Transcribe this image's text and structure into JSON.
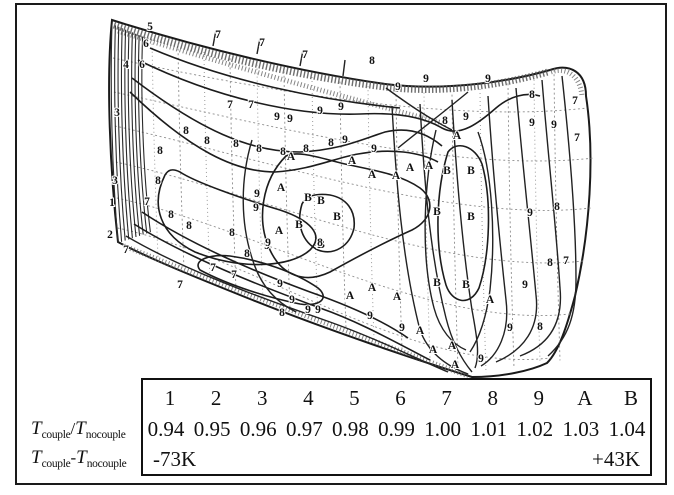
{
  "legend_table": {
    "levels": [
      "1",
      "2",
      "3",
      "4",
      "5",
      "6",
      "7",
      "8",
      "9",
      "A",
      "B"
    ],
    "ratios": [
      "0.94",
      "0.95",
      "0.96",
      "0.97",
      "0.98",
      "0.99",
      "1.00",
      "1.01",
      "1.02",
      "1.03",
      "1.04"
    ],
    "delta_min": "-73K",
    "delta_max": "+43K"
  },
  "side_labels": {
    "ratio": {
      "T1": "T",
      "sub1": "couple",
      "op": "/",
      "T2": "T",
      "sub2": "nocouple"
    },
    "delta": {
      "T1": "T",
      "sub1": "couple",
      "op": "-",
      "T2": "T",
      "sub2": "nocouple"
    }
  },
  "chart_data": {
    "type": "heatmap",
    "subtype": "contour",
    "title": "",
    "legend_position": "bottom",
    "contour_levels": [
      "1",
      "2",
      "3",
      "4",
      "5",
      "6",
      "7",
      "8",
      "9",
      "A",
      "B"
    ],
    "series": [
      {
        "name": "Tcouple/Tnocouple",
        "values": [
          0.94,
          0.95,
          0.96,
          0.97,
          0.98,
          0.99,
          1.0,
          1.01,
          1.02,
          1.03,
          1.04
        ]
      },
      {
        "name": "Tcouple-Tnocouple",
        "range": [
          "-73K",
          "+43K"
        ]
      }
    ]
  },
  "contour": {
    "labels": [
      {
        "c": "5",
        "x": 150,
        "y": 30
      },
      {
        "c": "6",
        "x": 146,
        "y": 47
      },
      {
        "c": "6",
        "x": 142,
        "y": 68
      },
      {
        "c": "4",
        "x": 126,
        "y": 68
      },
      {
        "c": "3",
        "x": 117,
        "y": 116
      },
      {
        "c": "3",
        "x": 115,
        "y": 184
      },
      {
        "c": "1",
        "x": 112,
        "y": 206
      },
      {
        "c": "2",
        "x": 110,
        "y": 238
      },
      {
        "c": "7",
        "x": 147,
        "y": 205
      },
      {
        "c": "8",
        "x": 160,
        "y": 154
      },
      {
        "c": "8",
        "x": 158,
        "y": 184
      },
      {
        "c": "8",
        "x": 171,
        "y": 218
      },
      {
        "c": "8",
        "x": 189,
        "y": 229
      },
      {
        "c": "8",
        "x": 186,
        "y": 134
      },
      {
        "c": "8",
        "x": 207,
        "y": 144
      },
      {
        "c": "7",
        "x": 218,
        "y": 38
      },
      {
        "c": "7",
        "x": 262,
        "y": 46
      },
      {
        "c": "7",
        "x": 305,
        "y": 58
      },
      {
        "c": "7",
        "x": 230,
        "y": 108
      },
      {
        "c": "7",
        "x": 251,
        "y": 108
      },
      {
        "c": "8",
        "x": 236,
        "y": 147
      },
      {
        "c": "8",
        "x": 259,
        "y": 152
      },
      {
        "c": "8",
        "x": 283,
        "y": 155
      },
      {
        "c": "8",
        "x": 306,
        "y": 152
      },
      {
        "c": "8",
        "x": 331,
        "y": 146
      },
      {
        "c": "9",
        "x": 277,
        "y": 120
      },
      {
        "c": "9",
        "x": 290,
        "y": 122
      },
      {
        "c": "9",
        "x": 320,
        "y": 114
      },
      {
        "c": "9",
        "x": 341,
        "y": 110
      },
      {
        "c": "8",
        "x": 372,
        "y": 64
      },
      {
        "c": "9",
        "x": 398,
        "y": 90
      },
      {
        "c": "9",
        "x": 426,
        "y": 82
      },
      {
        "c": "9",
        "x": 488,
        "y": 82
      },
      {
        "c": "8",
        "x": 532,
        "y": 98
      },
      {
        "c": "7",
        "x": 575,
        "y": 104
      },
      {
        "c": "9",
        "x": 554,
        "y": 128
      },
      {
        "c": "7",
        "x": 577,
        "y": 141
      },
      {
        "c": "9",
        "x": 532,
        "y": 126
      },
      {
        "c": "8",
        "x": 445,
        "y": 124
      },
      {
        "c": "9",
        "x": 466,
        "y": 120
      },
      {
        "c": "9",
        "x": 345,
        "y": 143
      },
      {
        "c": "9",
        "x": 374,
        "y": 152
      },
      {
        "c": "A",
        "x": 352,
        "y": 164
      },
      {
        "c": "A",
        "x": 372,
        "y": 178
      },
      {
        "c": "A",
        "x": 396,
        "y": 179
      },
      {
        "c": "A",
        "x": 410,
        "y": 171
      },
      {
        "c": "A",
        "x": 429,
        "y": 169
      },
      {
        "c": "A",
        "x": 457,
        "y": 139
      },
      {
        "c": "B",
        "x": 447,
        "y": 174
      },
      {
        "c": "B",
        "x": 471,
        "y": 174
      },
      {
        "c": "A",
        "x": 291,
        "y": 160
      },
      {
        "c": "A",
        "x": 281,
        "y": 191
      },
      {
        "c": "A",
        "x": 279,
        "y": 234
      },
      {
        "c": "B",
        "x": 308,
        "y": 201
      },
      {
        "c": "B",
        "x": 321,
        "y": 204
      },
      {
        "c": "B",
        "x": 337,
        "y": 220
      },
      {
        "c": "B",
        "x": 299,
        "y": 228
      },
      {
        "c": "B",
        "x": 321,
        "y": 248
      },
      {
        "c": "9",
        "x": 257,
        "y": 197
      },
      {
        "c": "9",
        "x": 256,
        "y": 211
      },
      {
        "c": "9",
        "x": 267,
        "y": 249
      },
      {
        "c": "9",
        "x": 280,
        "y": 287
      },
      {
        "c": "B",
        "x": 437,
        "y": 215
      },
      {
        "c": "B",
        "x": 471,
        "y": 220
      },
      {
        "c": "8",
        "x": 557,
        "y": 210
      },
      {
        "c": "9",
        "x": 530,
        "y": 216
      },
      {
        "c": "8",
        "x": 540,
        "y": 330
      },
      {
        "c": "9",
        "x": 525,
        "y": 288
      },
      {
        "c": "8",
        "x": 550,
        "y": 266
      },
      {
        "c": "7",
        "x": 566,
        "y": 264
      },
      {
        "c": "8",
        "x": 232,
        "y": 236
      },
      {
        "c": "9",
        "x": 268,
        "y": 246
      },
      {
        "c": "8",
        "x": 247,
        "y": 257
      },
      {
        "c": "9",
        "x": 292,
        "y": 303
      },
      {
        "c": "8",
        "x": 282,
        "y": 316
      },
      {
        "c": "9",
        "x": 308,
        "y": 313
      },
      {
        "c": "9",
        "x": 318,
        "y": 313
      },
      {
        "c": "7",
        "x": 213,
        "y": 271
      },
      {
        "c": "7",
        "x": 234,
        "y": 278
      },
      {
        "c": "7",
        "x": 180,
        "y": 288
      },
      {
        "c": "7",
        "x": 126,
        "y": 253
      },
      {
        "c": "8",
        "x": 320,
        "y": 246
      },
      {
        "c": "A",
        "x": 350,
        "y": 299
      },
      {
        "c": "A",
        "x": 372,
        "y": 291
      },
      {
        "c": "A",
        "x": 397,
        "y": 300
      },
      {
        "c": "9",
        "x": 370,
        "y": 319
      },
      {
        "c": "9",
        "x": 402,
        "y": 331
      },
      {
        "c": "A",
        "x": 420,
        "y": 334
      },
      {
        "c": "9",
        "x": 510,
        "y": 331
      },
      {
        "c": "A",
        "x": 452,
        "y": 349
      },
      {
        "c": "A",
        "x": 433,
        "y": 353
      },
      {
        "c": "9",
        "x": 481,
        "y": 362
      },
      {
        "c": "B",
        "x": 437,
        "y": 286
      },
      {
        "c": "B",
        "x": 466,
        "y": 288
      },
      {
        "c": "A",
        "x": 490,
        "y": 303
      },
      {
        "c": "A",
        "x": 455,
        "y": 368
      }
    ]
  }
}
